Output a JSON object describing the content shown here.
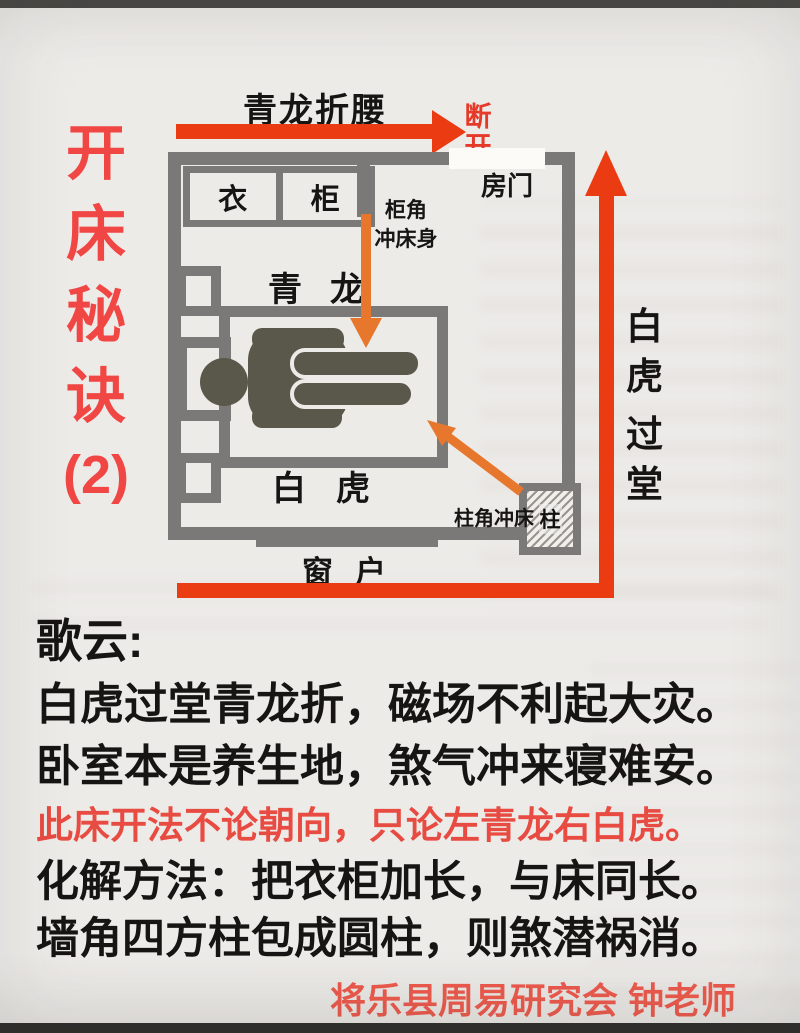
{
  "header": {
    "series_title_chars": [
      "开",
      "床",
      "秘",
      "诀",
      "(2)"
    ]
  },
  "diagram": {
    "top_arrow_label": "青龙折腰",
    "break_chars": [
      "断",
      "开"
    ],
    "door_label": "房门",
    "wardrobe_left_char": "衣",
    "wardrobe_right_char": "柜",
    "cabinet_warning_line1": "柜角",
    "cabinet_warning_line2": "冲床身",
    "qinglong_label": "青龙",
    "baihu_label": "白虎",
    "window_label": "窗户",
    "pillar_label": "柱",
    "pillar_warning_label": "柱角冲床",
    "right_arrow_chars": [
      "白",
      "虎",
      "过",
      "堂"
    ]
  },
  "verse": {
    "heading": "歌云:",
    "line1": "白虎过堂青龙折，磁场不利起大灾。",
    "line2": "卧室本是养生地，煞气冲来寝难安。",
    "line3_red": "此床开法不论朝向，只论左青龙右白虎。",
    "line4": "化解方法：把衣柜加长，与床同长。",
    "line5": "墙角四方柱包成圆柱，则煞潜祸消。",
    "attribution": "将乐县周易研究会 钟老师"
  },
  "colors": {
    "wall_gray": "#7b7977",
    "arrow_red": "#eb3b13",
    "title_red": "#f04745",
    "warning_red": "#e74b41",
    "attribution_red": "#ef5a4d",
    "orange_arrow": "#e8772e",
    "person_olive": "#5a584b",
    "paper": "#edebe8"
  }
}
